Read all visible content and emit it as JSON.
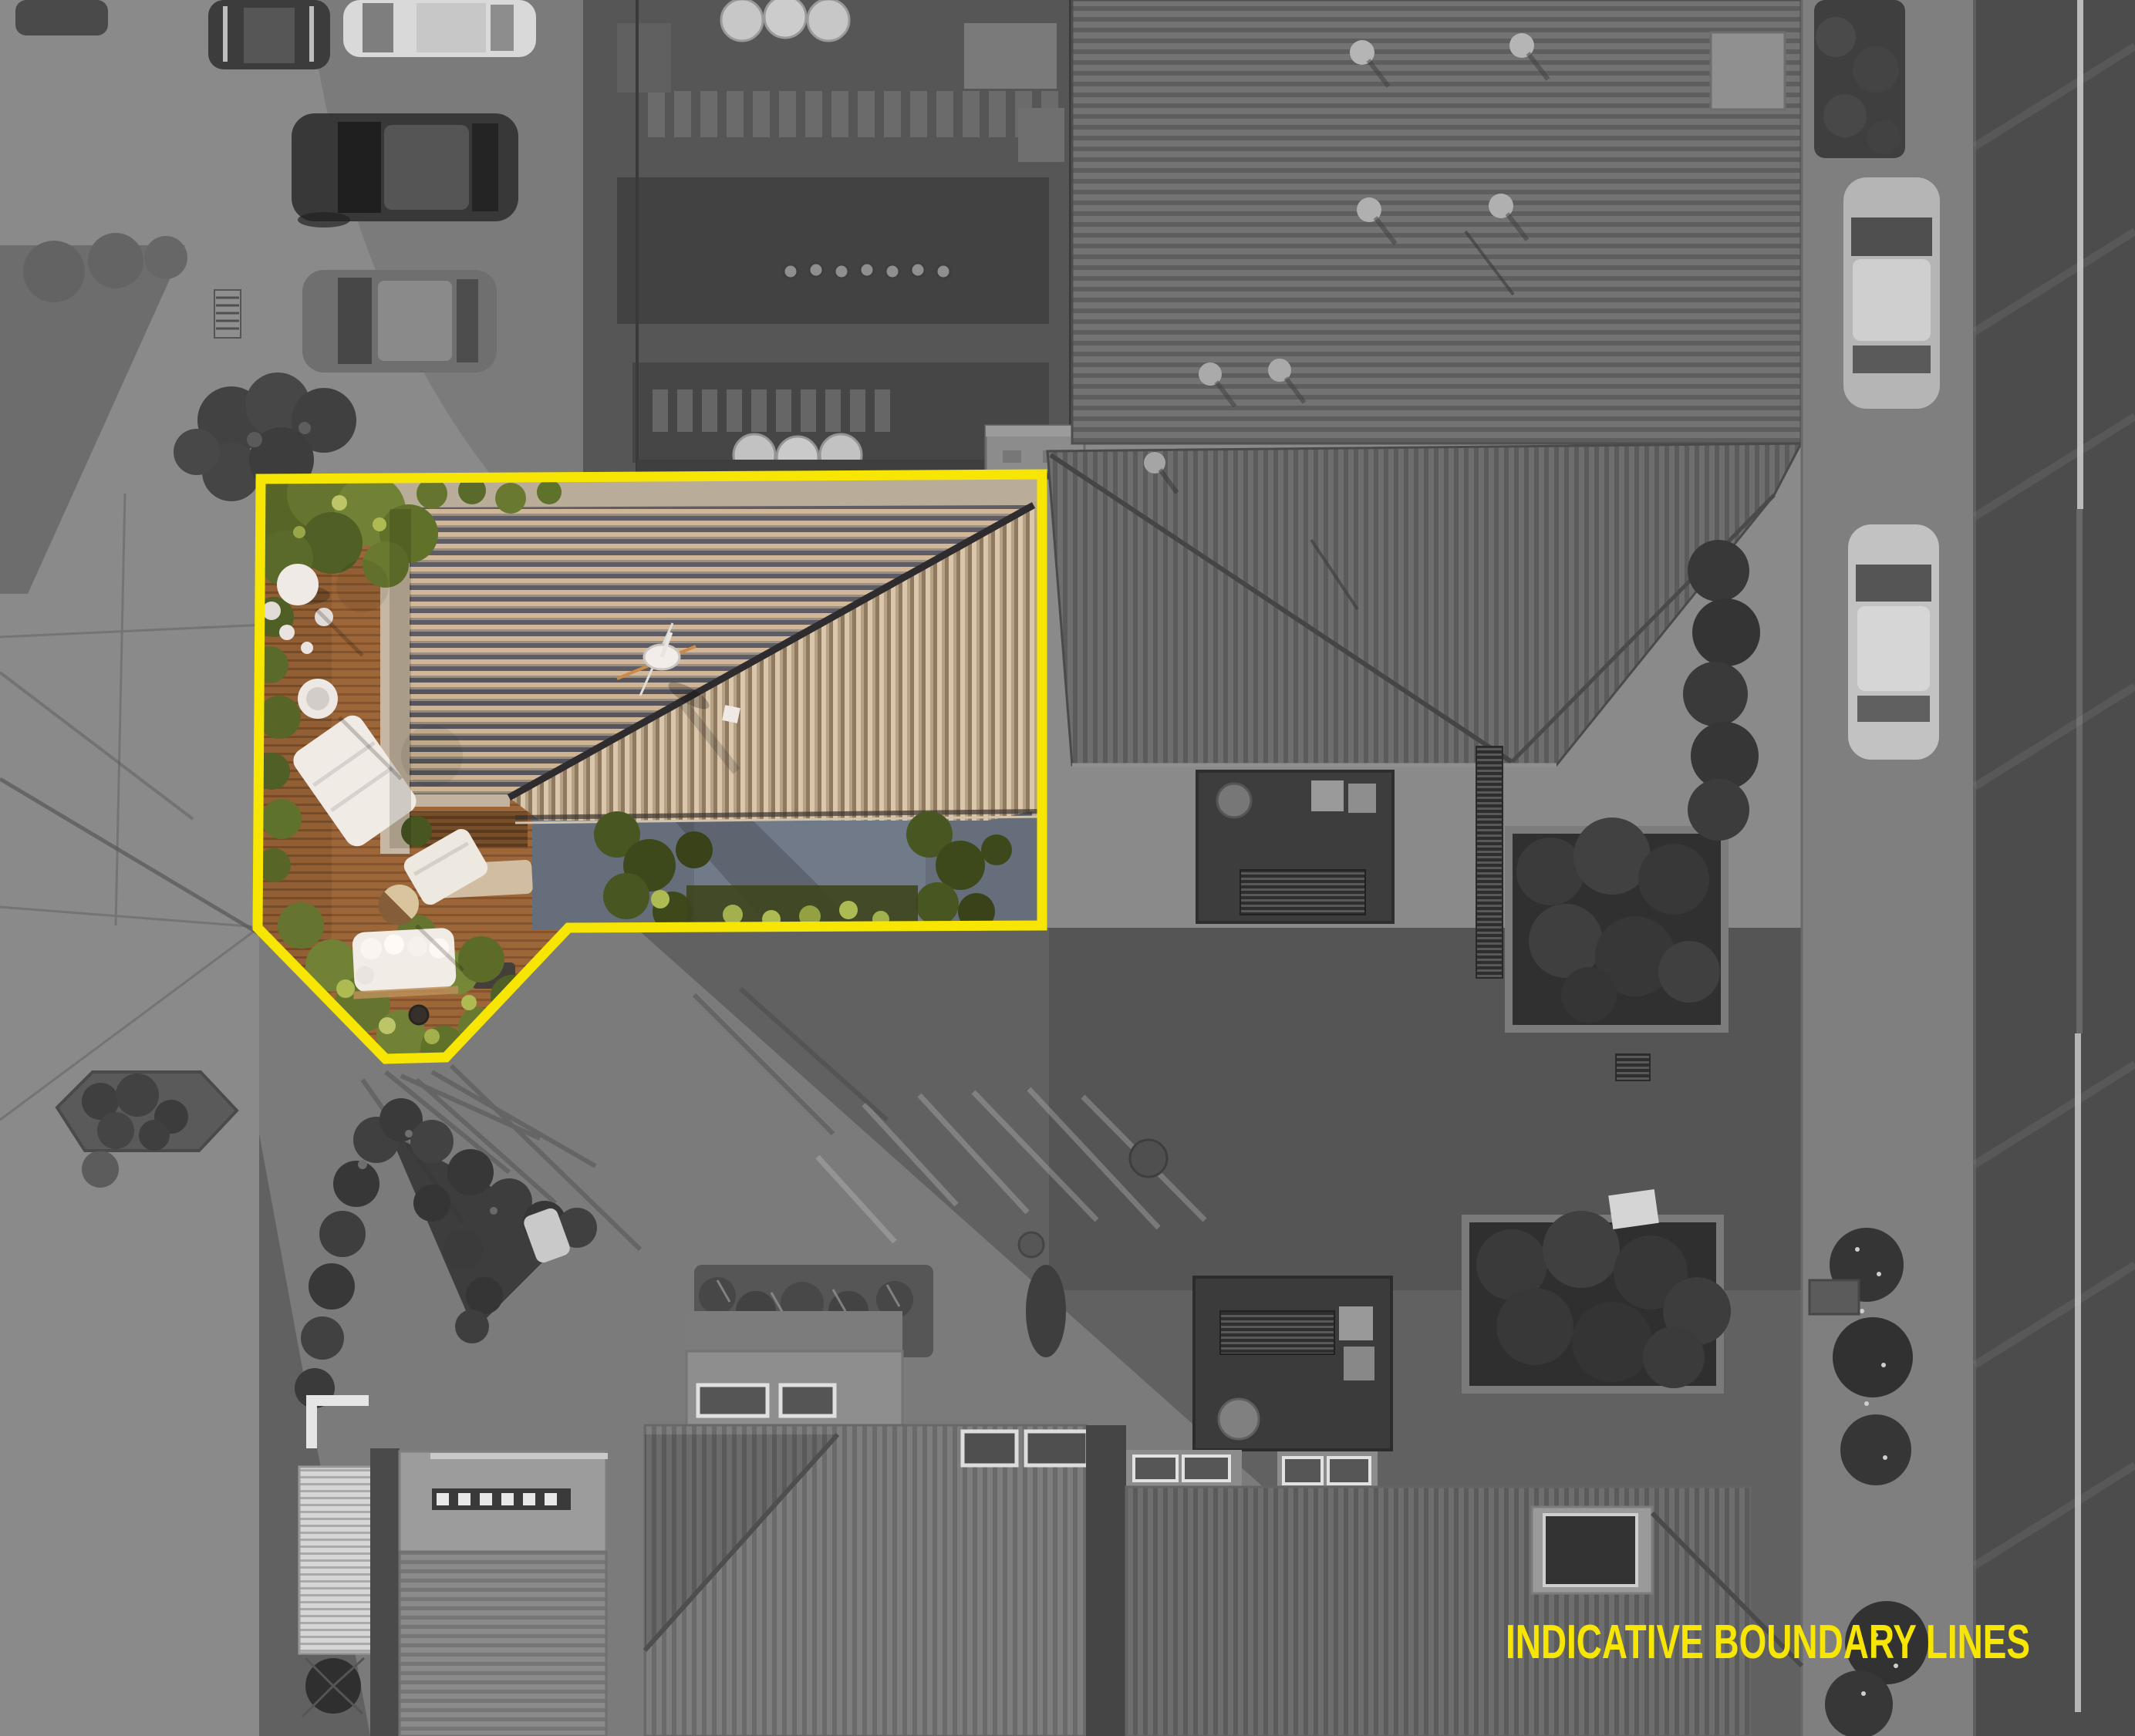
{
  "annotation": {
    "label": "INDICATIVE BOUNDARY LINES",
    "color": "#F7E604",
    "boundary_points": "338,621 1351,615 1351,1200 737,1203 578,1371 500,1373 334,1203",
    "line_width": "13"
  },
  "scene": {
    "kind": "aerial-drone-photograph",
    "treatment": "surroundings desaturated to grayscale; property inside the yellow boundary shown in full colour",
    "palette": {
      "boundary_yellow": "#F7E604",
      "deck_timber_brown": "#8D5C34",
      "house_roof_tan": "#CDB699",
      "house_roof_shadow_slate": "#4D5260",
      "driveway_blue_grey": "#5E6C80",
      "garden_green": "#5C742E",
      "paving_light_grey": "#8A8A8A",
      "paving_dark_grey": "#616161",
      "road_asphalt": "#4C4C4C",
      "neighbour_roof_grey": "#717171"
    },
    "elements": [
      "parked-cars-top-left",
      "courtyard-gardens-top",
      "neighbour-roof-top-right",
      "footpath-and-road-right",
      "street-parked-cars",
      "street-trees",
      "highlighted-property",
      "house-roof-two-planes",
      "satellite-dish",
      "timber-deck",
      "outdoor-furniture",
      "blue-paved-driveway",
      "garden-shrubs",
      "service-yards",
      "hedge-gardens",
      "neighbour-roofs-bottom",
      "central-paved-courtyard",
      "sunlit-shadow-wedge",
      "manhole-covers",
      "road-lane-line"
    ]
  }
}
